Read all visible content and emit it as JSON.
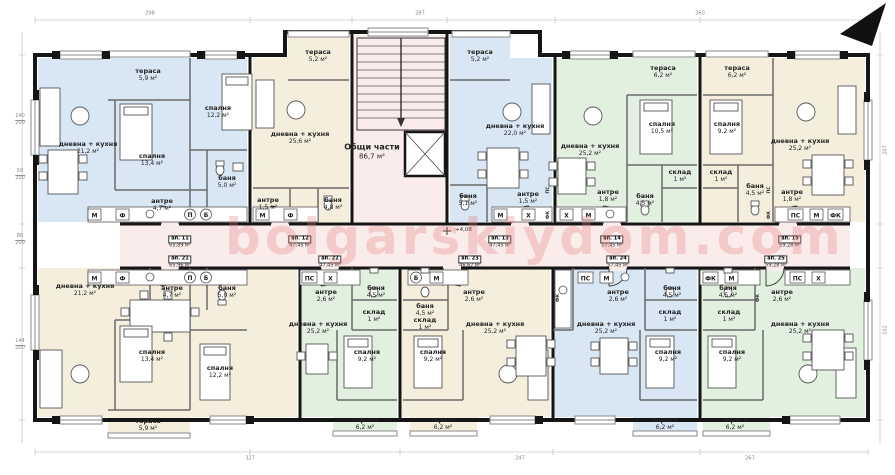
{
  "palette": {
    "blue": "#d9e6f4",
    "beige": "#f6eedd",
    "green": "#e2f0e0",
    "pink": "#fbecec",
    "wall": "#151515"
  },
  "watermark": "bolgarskiydom.com",
  "common": {
    "name": "Общи части",
    "area": "86,7 м²",
    "elevation": "+4,08"
  },
  "apartments": [
    {
      "id": "top-left",
      "tint": "blue",
      "rooms": [
        {
          "name": "дневна + кухня",
          "area": "21,2 м²"
        },
        {
          "name": "тераса",
          "area": "5,9 м²"
        },
        {
          "name": "спалня",
          "area": "12,2 м²"
        },
        {
          "name": "спалня",
          "area": "13,4 м²"
        },
        {
          "name": "баня",
          "area": "5,0 м²"
        },
        {
          "name": "антре",
          "area": "4,7 м²"
        }
      ]
    },
    {
      "id": "top-mid-left",
      "tint": "beige",
      "rooms": [
        {
          "name": "дневна + кухня",
          "area": "25,6 м²"
        },
        {
          "name": "тераса",
          "area": "5,2 м²"
        },
        {
          "name": "баня",
          "area": "4,8 м²"
        },
        {
          "name": "антре",
          "area": "1,5 м²"
        }
      ]
    },
    {
      "id": "top-mid-right",
      "tint": "blue",
      "rooms": [
        {
          "name": "дневна + кухня",
          "area": "22,0 м²"
        },
        {
          "name": "тераса",
          "area": "5,2 м²"
        },
        {
          "name": "баня",
          "area": "5,1 м²"
        },
        {
          "name": "антре",
          "area": "1,5 м²"
        }
      ]
    },
    {
      "id": "top-right",
      "tint": "green",
      "rooms": [
        {
          "name": "дневна + кухня",
          "area": "25,2 м²"
        },
        {
          "name": "спалня",
          "area": "10,5 м²"
        },
        {
          "name": "тераса",
          "area": "6,2 м²"
        },
        {
          "name": "антре",
          "area": "1,8 м²"
        },
        {
          "name": "баня",
          "area": "4,5 м²"
        },
        {
          "name": "склад",
          "area": "1 м²"
        }
      ]
    },
    {
      "id": "top-far-right",
      "tint": "beige",
      "rooms": [
        {
          "name": "дневна + кухня",
          "area": "25,2 м²"
        },
        {
          "name": "спалня",
          "area": "9,2 м²"
        },
        {
          "name": "тераса",
          "area": "6,2 м²"
        },
        {
          "name": "антре",
          "area": "1,8 м²"
        },
        {
          "name": "баня",
          "area": "4,5 м²"
        },
        {
          "name": "склад",
          "area": "1 м²"
        }
      ]
    },
    {
      "id": "bottom-left",
      "tint": "beige",
      "rooms": [
        {
          "name": "дневна + кухня",
          "area": "21,2 м²"
        },
        {
          "name": "антре",
          "area": "4,7 м²"
        },
        {
          "name": "баня",
          "area": "5,0 м²"
        },
        {
          "name": "спалня",
          "area": "13,4 м²"
        },
        {
          "name": "спалня",
          "area": "12,2 м²"
        },
        {
          "name": "тераса",
          "area": "5,9 м²"
        }
      ]
    },
    {
      "id": "bottom-mid-left",
      "tint": "green",
      "rooms": [
        {
          "name": "дневна + кухня",
          "area": "25,2 м²"
        },
        {
          "name": "антре",
          "area": "2,6 м²"
        },
        {
          "name": "баня",
          "area": "4,5 м²"
        },
        {
          "name": "склад",
          "area": "1 м²"
        },
        {
          "name": "спалня",
          "area": "9,2 м²"
        },
        {
          "name": "тераса",
          "area": "6,2 м²"
        }
      ]
    },
    {
      "id": "bottom-mid",
      "tint": "beige",
      "rooms": [
        {
          "name": "дневна + кухня",
          "area": "25,2 м²"
        },
        {
          "name": "антре",
          "area": "2,6 м²"
        },
        {
          "name": "баня",
          "area": "4,5 м²"
        },
        {
          "name": "склад",
          "area": "1 м²"
        },
        {
          "name": "спалня",
          "area": "9,2 м²"
        },
        {
          "name": "тераса",
          "area": "6,2 м²"
        }
      ]
    },
    {
      "id": "bottom-mid-right",
      "tint": "blue",
      "rooms": [
        {
          "name": "дневна + кухня",
          "area": "25,2 м²"
        },
        {
          "name": "антре",
          "area": "2,6 м²"
        },
        {
          "name": "баня",
          "area": "4,5 м²"
        },
        {
          "name": "склад",
          "area": "1 м²"
        },
        {
          "name": "спалня",
          "area": "9,2 м²"
        },
        {
          "name": "тераса",
          "area": "6,2 м²"
        }
      ]
    },
    {
      "id": "bottom-far-right",
      "tint": "green",
      "rooms": [
        {
          "name": "дневна + кухня",
          "area": "25,2 м²"
        },
        {
          "name": "антре",
          "area": "2,6 м²"
        },
        {
          "name": "баня",
          "area": "4,5 м²"
        },
        {
          "name": "склад",
          "area": "1 м²"
        },
        {
          "name": "спалня",
          "area": "9,2 м²"
        },
        {
          "name": "тераса",
          "area": "6,2 м²"
        }
      ]
    }
  ],
  "tags": [
    {
      "num": "ап. 11",
      "area": "65,89 м²"
    },
    {
      "num": "ап. 12",
      "area": "47,45 м²"
    },
    {
      "num": "ап. 13",
      "area": "47,45 м²"
    },
    {
      "num": "ап. 14",
      "area": "57,45 м²"
    },
    {
      "num": "ап. 15",
      "area": "59,28 м²"
    },
    {
      "num": "ап. 21",
      "area": "65,96 м²"
    },
    {
      "num": "ап. 22",
      "area": "47,45 м²"
    },
    {
      "num": "ап. 23",
      "area": "46,67 м²"
    },
    {
      "num": "ап. 24",
      "area": "57,45 м²"
    },
    {
      "num": "ап. 25",
      "area": "59,28 м²"
    }
  ],
  "appliances": {
    "m": "М",
    "f": "Ф",
    "p": "П",
    "b": "Б",
    "x": "Х",
    "ps": "ПС",
    "fk": "ФК"
  },
  "dims": [
    "140",
    "200",
    "50",
    "200",
    "80",
    "200",
    "144",
    "200",
    "298",
    "287",
    "360",
    "327",
    "247",
    "267",
    "207",
    "102"
  ]
}
